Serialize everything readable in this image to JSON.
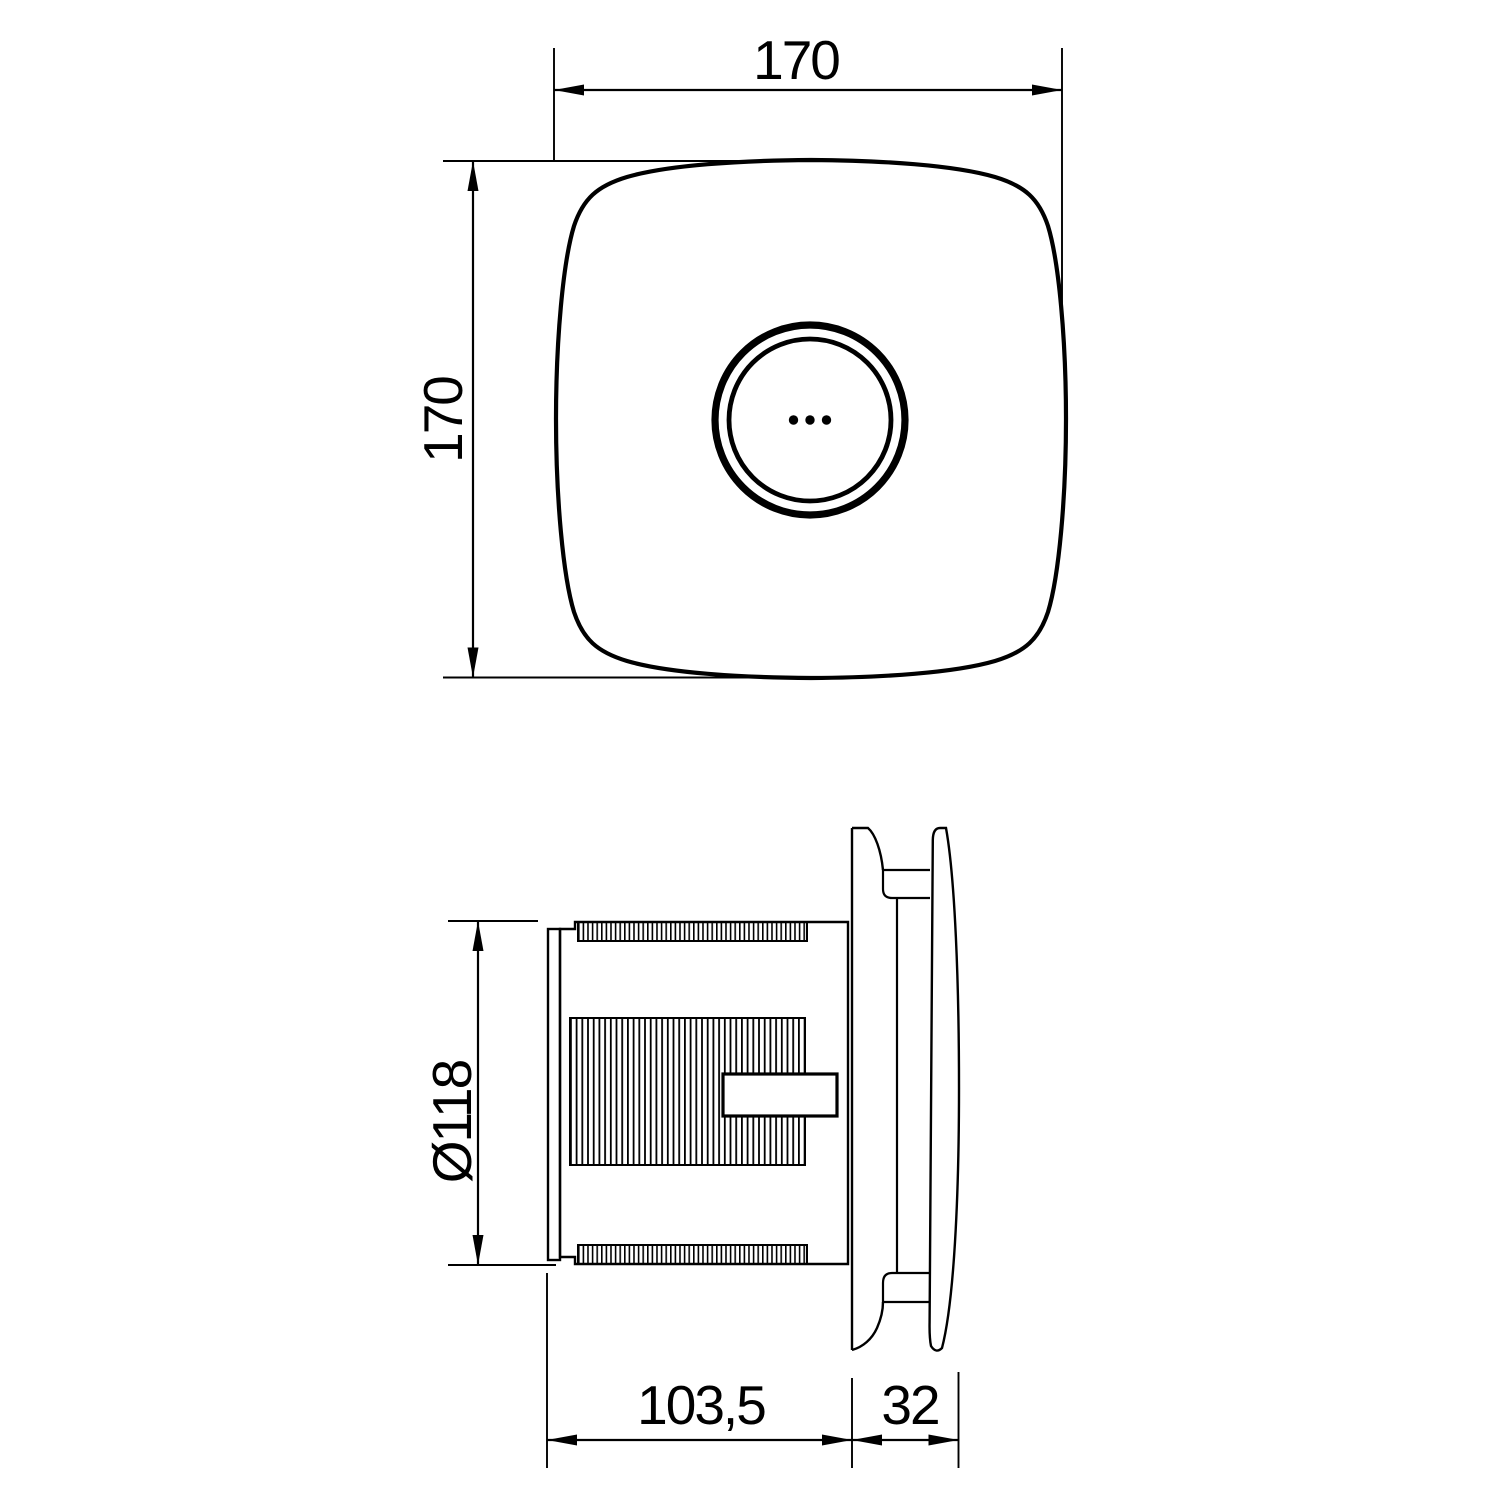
{
  "drawing": {
    "type": "technical-dimension-drawing",
    "line_color": "#000000",
    "background": "#ffffff"
  },
  "labels": {
    "front_width": "170",
    "front_height": "170",
    "duct_diameter": "Ø118",
    "depth_body": "103,5",
    "depth_front": "32"
  },
  "views": {
    "front_view": {
      "width_mm": "170",
      "height_mm": "170",
      "features": [
        "rounded-square face plate",
        "double ring grille",
        "three indicator dots"
      ]
    },
    "side_view": {
      "duct_diameter_mm": "Ø118",
      "body_depth_mm": "103,5",
      "cover_depth_mm": "32",
      "features": [
        "back flange",
        "ribbed duct body",
        "terminal box",
        "mounting frame",
        "curved front cover"
      ]
    }
  }
}
